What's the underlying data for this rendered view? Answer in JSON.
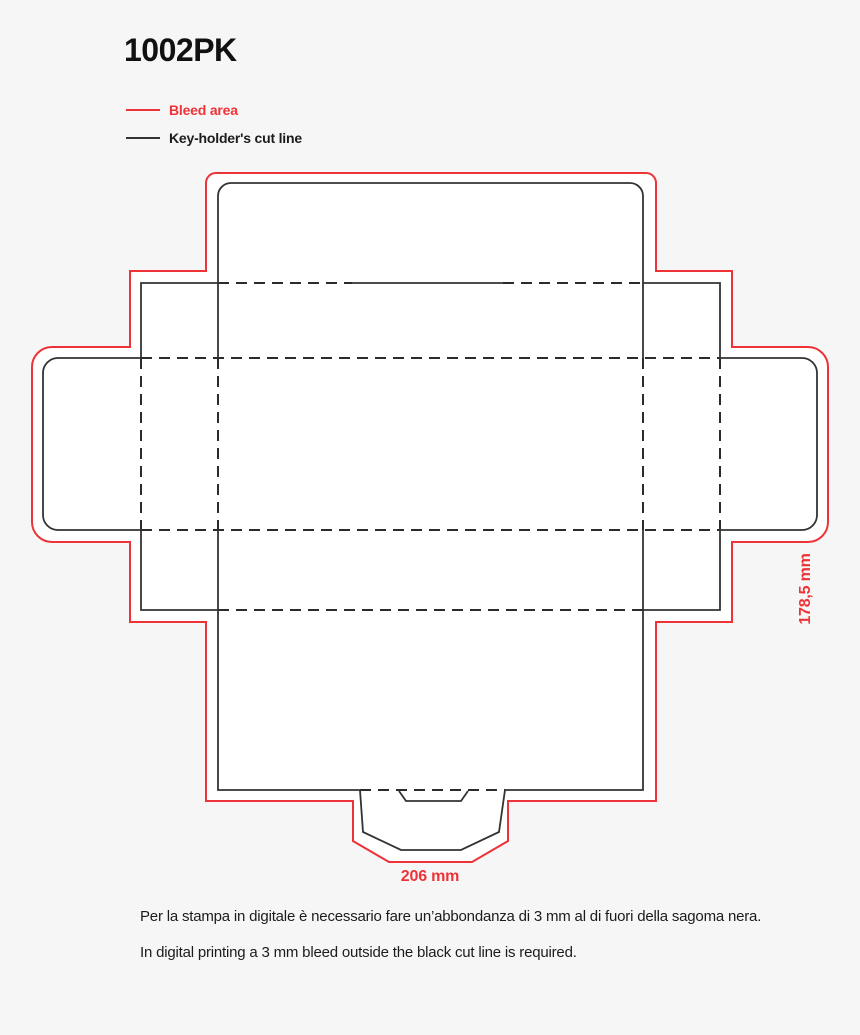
{
  "page": {
    "title": "1002PK"
  },
  "legend": {
    "items": [
      {
        "name": "bleed-area",
        "label": "Bleed area"
      },
      {
        "name": "cut-line",
        "label": "Key-holder's cut line"
      }
    ]
  },
  "diagram": {
    "dimensions": {
      "width_label": "206 mm",
      "height_label": "178,5 mm"
    }
  },
  "footer": {
    "line_it": "Per la stampa in digitale è necessario fare un’abbondanza di 3 mm al di fuori della sagoma nera.",
    "line_en": "In digital printing a 3 mm bleed outside the black cut line is required."
  },
  "colors": {
    "bleed": "#ee3338",
    "cut": "#333333",
    "background": "#f6f6f6",
    "panel": "#ffffff"
  }
}
